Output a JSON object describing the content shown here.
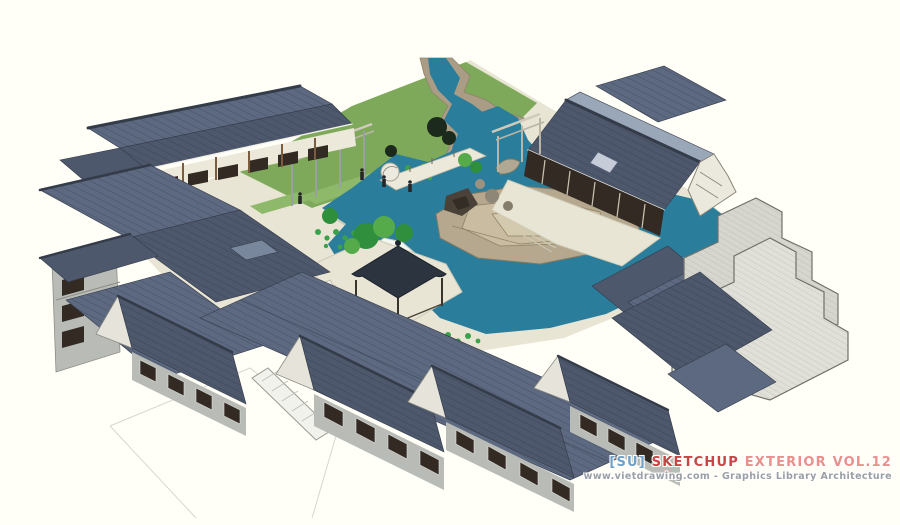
{
  "watermark": {
    "su": "[SU]",
    "title": "SKETCHUP",
    "suffix": "EXTERIOR VOL.12",
    "url_line": "www.vietdrawing.com - Graphics Library Architecture"
  },
  "colors": {
    "background": "#fffef7",
    "paving": "#e9e5d4",
    "paving_shade": "#cfcbb8",
    "grass": "#7ea95a",
    "grass_light": "#8fb96a",
    "water": "#2a7e9b",
    "bank_tan": "#ab9d85",
    "stone_tan": "#b5a88f",
    "stone_tan2": "#c9bca0",
    "rock_white": "#f4f6f0",
    "roof_dark": "#4e586c",
    "roof_mid": "#5d6980",
    "roof_light": "#78879c",
    "roof_pale": "#9aa7b8",
    "roof_ridge": "#343b49",
    "wall_cream": "#ece8da",
    "wall_gray": "#b9bcb6",
    "wall_stone": "#d9d9d1",
    "wood_dark": "#332b23",
    "wood_brown": "#7a5c3e",
    "tree_green": "#2f8f3c",
    "tree_light": "#55ab4a",
    "tree_dark": "#1c2a1d",
    "gazebo_roof": "#2c3440",
    "figure_dark": "#26262a",
    "wm_su": "#6ea0c8",
    "wm_sketchup": "#c94545",
    "wm_exterior": "#e8908c",
    "wm_url": "#9aa0a6"
  }
}
